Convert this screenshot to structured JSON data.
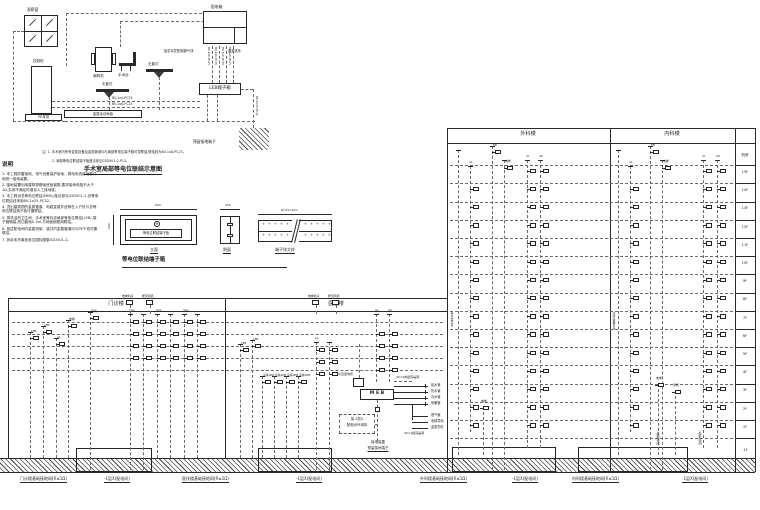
{
  "colors": {
    "ink": "#222222",
    "bg": "#ffffff"
  },
  "equipment": {
    "window": "观察窗",
    "cabinet": "控制柜",
    "cabinet_base": "PE母排",
    "machine": "麻醉机",
    "op_table": "手术台",
    "lamp1": "无影灯",
    "lamp2": "无影灯",
    "floor_bar": "金属活动地板",
    "panel": "配电箱",
    "note_pe": "接至本层配电箱PE排",
    "note_power": "电源进线",
    "leb_box": "LEB端子箱",
    "ground": "预留接地端子",
    "wire6": "BV-1x6-PC25",
    "wire4": "BV-1x4-PC25",
    "wire25": "BV-1x25-PC32"
  },
  "top_notes": {
    "line1": "注: 1. 手术室内所有金属设备及金属管道均与局部等电位端子箱可靠联结,联结线为BV-1x6-PC25。",
    "line2": "2. 局部等电位联结端子板做法参见02D501-2-P15。"
  },
  "notes": {
    "title": "说明",
    "items": [
      "1. 本工程防雷接地、电气设备保护接地、弱电系统接地等共用统一接地装置。",
      "2. 接地装置利用建筑物基础底板钢筋,要求接地电阻不大于1Ω,实测不满足时增设人工接地极。",
      "3. 本工程设总等电位联结(MEB),做法参见02D501-2,总等电位联结线采用BV-1x25-PC32。",
      "4. 进出建筑物的金属管道、电缆金属外皮等在入户处与总等电位联结端子板可靠联结。",
      "5. 带洗浴的卫生间、手术室等均设局部等电位联结(LEB),端子箱暗装,底边距地0.3m,与地面钢筋网联结。",
      "6. 各层配电间内金属桥架、竖井内金属管道均与PE干线可靠联结。",
      "7. 其余未尽事宜参见国标图集02D501-2。"
    ]
  },
  "lp_title": "手术室局部等电位联结示意图",
  "detail": {
    "caption": "等电位联结端子箱",
    "front": "立面",
    "side": "侧面",
    "strip": "端子排大样",
    "sym": "⊕",
    "plate": "等电位联结端子板",
    "dim_w": "600",
    "dim_h": "300",
    "dim_side": "150",
    "dim_strip": "8×25=200"
  },
  "bottom_left": {
    "b1": "门诊楼",
    "b2": "医技楼"
  },
  "right_tables": {
    "b1": "外科楼",
    "b2": "内科楼",
    "floors": [
      "机房",
      "15F",
      "14F",
      "13F",
      "12F",
      "11F",
      "10F",
      "9F",
      "8F",
      "7F",
      "6F",
      "5F",
      "4F",
      "3F",
      "2F",
      "1F",
      "-1F"
    ]
  },
  "ground_labels": [
    "门诊楼基础接地网(R≤1Ω)",
    "-1层X(配电间)",
    "医技楼基础接地网(R≤1Ω)",
    "-1层X(配电间)",
    "外科楼基础接地网(R≤1Ω)",
    "-1层X(配电间)",
    "内科楼基础接地网(R≤1Ω)",
    "-1层X(配电间)"
  ],
  "meb": {
    "box": "M E B",
    "feeder": "引自变电所",
    "flat1": "40×4热镀锌扁钢",
    "flat2": "40×4镀锌扁钢",
    "src1": "接-1层X",
    "src2": "配电间PE母排",
    "p1": "给水管",
    "p2": "热水管",
    "p3": "污水管",
    "p4": "采暖管",
    "p5": "燃气管",
    "p6": "电梯导轨",
    "p7": "金属构件",
    "gnd1": "接地装置",
    "gnd2": "预留接地端子"
  },
  "tags": {
    "leb": "LEB",
    "al": "AL",
    "ap": "AP",
    "eb": "EB",
    "dt": "电梯",
    "fj": "风机",
    "sb": "设备LEB",
    "al1": "1AL",
    "al2": "2AL",
    "al3": "3AL",
    "dtjf": "电梯机房",
    "wdfj": "屋顶风机",
    "ssl": "手术室LEB",
    "zl": "诊疗设备LEB",
    "b1f": "-1层配电间"
  }
}
